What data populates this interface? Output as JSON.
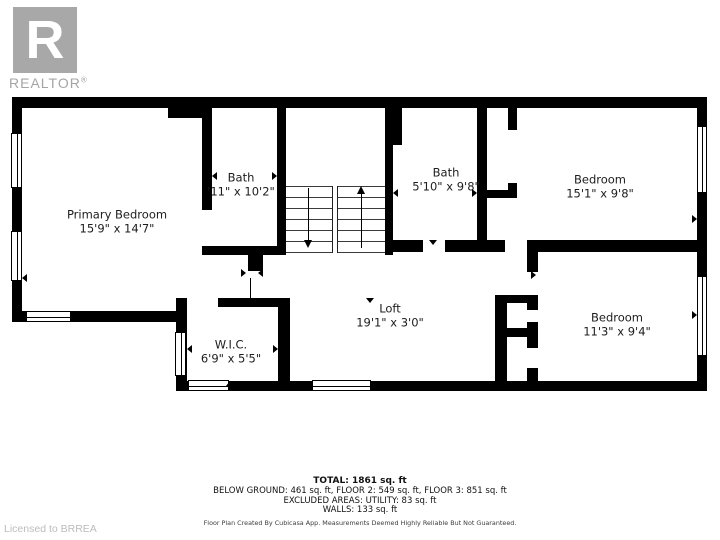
{
  "logo": {
    "letter": "R",
    "brand": "REALTOR",
    "registered": "®"
  },
  "rooms": [
    {
      "id": "primary-bedroom",
      "name": "Primary Bedroom",
      "dims": "15'9\" x 14'7\""
    },
    {
      "id": "bath-upper",
      "name": "Bath",
      "dims": "'11\" x 10'2\""
    },
    {
      "id": "bath-middle",
      "name": "Bath",
      "dims": "5'10\" x 9'8\""
    },
    {
      "id": "bedroom-top-right",
      "name": "Bedroom",
      "dims": "15'1\" x 9'8\""
    },
    {
      "id": "wic",
      "name": "W.I.C.",
      "dims": "6'9\" x 5'5\""
    },
    {
      "id": "loft",
      "name": "Loft",
      "dims": "19'1\" x 3'0\""
    },
    {
      "id": "bedroom-bottom-right",
      "name": "Bedroom",
      "dims": "11'3\" x 9'4\""
    }
  ],
  "summary": {
    "total": "TOTAL: 1861 sq. ft",
    "floors": "BELOW GROUND: 461 sq. ft, FLOOR 2: 549 sq. ft, FLOOR 3: 851 sq. ft",
    "excluded": "EXCLUDED AREAS: UTILITY: 83 sq. ft",
    "walls": "WALLS: 133 sq. ft",
    "disclaimer": "Floor Plan Created By Cubicasa App. Measurements Deemed Highly Reliable But Not Guaranteed."
  },
  "footer": {
    "licensed": "Licensed to BRREA"
  }
}
